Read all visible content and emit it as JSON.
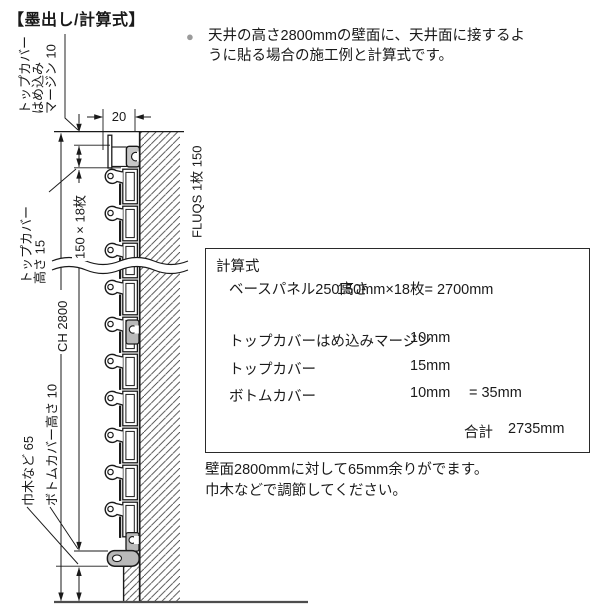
{
  "title": "【墨出し/計算式】",
  "intro": {
    "bullet": "●",
    "line1": "天井の高さ2800mmの壁面に、天井面に接するよ",
    "line2": "うに貼る場合の施工例と計算式です。"
  },
  "diagram": {
    "dim_depth": "20",
    "label_top_margin_1": "トップカバー",
    "label_top_margin_2": "はめ込み",
    "label_top_margin_3": "マージン 10",
    "label_top_cover_1": "トップカバー",
    "label_top_cover_2": "高さ 15",
    "label_panel_stack": "150 × 18枚",
    "label_ceiling_height": "CH 2800",
    "label_product": "FLUQS 1枚 150",
    "label_bottom_cover": "ボトムカバー高さ 10",
    "label_skirting": "巾木など 65"
  },
  "calc_box": {
    "heading": "計算式",
    "rows": [
      {
        "label": "ベースパネル250高さ",
        "value": "150mm×18枚= 2700mm"
      },
      {
        "label": "トップカバーはめ込みマージン",
        "value": "10mm"
      },
      {
        "label": "トップカバー",
        "value": "15mm"
      },
      {
        "label": "ボトムカバー",
        "value": "10mm",
        "sum": "= 35mm"
      }
    ],
    "total_label": "合計",
    "total_value": "2735mm"
  },
  "footer": {
    "line1": "壁面2800mmに対して65mm余りがでます。",
    "line2": "巾木などで調節してください。"
  },
  "colors": {
    "ink": "#1a1a1a",
    "cover_gray": "#c7c7c7",
    "clip_gray": "#b9b9b9",
    "bullet_gray": "#9b9b9b",
    "floor_gray": "#4d4d4d"
  }
}
